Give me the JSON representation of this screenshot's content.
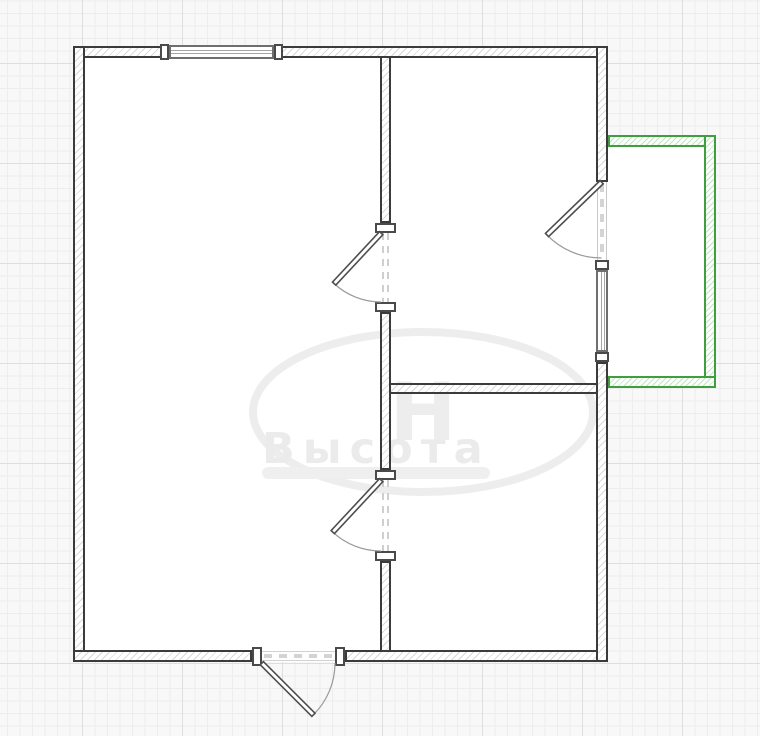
{
  "app": {
    "view": "floor-plan-canvas"
  },
  "watermark": {
    "text": "Высота",
    "monogram": "Н"
  },
  "colors": {
    "canvas_bg": "#f8f8f8",
    "grid_minor": "#ededed",
    "grid_major": "#dedede",
    "wall_line": "#3b3b3b",
    "wall_hatch": "#d9d9d9",
    "balcony_line": "#3f9e3f",
    "balcony_hatch": "#c4e2c4",
    "window_line": "#6f6f6f",
    "window_pane": "#a6a6a6",
    "door_line": "#4e4e4e",
    "door_arc": "#999999",
    "opening_dash": "#cfcfcf",
    "watermark": "#ebebeb"
  },
  "plan": {
    "rects": [
      {
        "name": "room-floor-building",
        "cls": "fill",
        "x": 73,
        "y": 46,
        "w": 535,
        "h": 616,
        "i": "true"
      },
      {
        "name": "room-floor-balcony",
        "cls": "fill",
        "x": 608,
        "y": 135,
        "w": 108,
        "h": 253,
        "i": "true"
      },
      {
        "name": "wall-exterior-top",
        "cls": "wall",
        "x": 73,
        "y": 46,
        "w": 535,
        "h": 12,
        "i": "true"
      },
      {
        "name": "wall-exterior-left",
        "cls": "wall",
        "x": 73,
        "y": 46,
        "w": 12,
        "h": 616,
        "i": "true"
      },
      {
        "name": "wall-exterior-bottom-left",
        "cls": "wall",
        "x": 73,
        "y": 650,
        "w": 179,
        "h": 12,
        "i": "true"
      },
      {
        "name": "wall-exterior-bottom-right",
        "cls": "wall",
        "x": 345,
        "y": 650,
        "w": 263,
        "h": 12,
        "i": "true"
      },
      {
        "name": "wall-exterior-right-upper",
        "cls": "wall",
        "x": 596,
        "y": 46,
        "w": 12,
        "h": 136,
        "i": "true"
      },
      {
        "name": "wall-exterior-right-lower",
        "cls": "wall",
        "x": 596,
        "y": 362,
        "w": 12,
        "h": 300,
        "i": "true"
      },
      {
        "name": "wall-interior-vertical-upper",
        "cls": "wall",
        "x": 380,
        "y": 56,
        "w": 11,
        "h": 167,
        "i": "true"
      },
      {
        "name": "wall-interior-vertical-middle",
        "cls": "wall",
        "x": 380,
        "y": 312,
        "w": 11,
        "h": 158,
        "i": "true"
      },
      {
        "name": "wall-interior-vertical-lower",
        "cls": "wall",
        "x": 380,
        "y": 561,
        "w": 11,
        "h": 91,
        "i": "true"
      },
      {
        "name": "wall-interior-horizontal",
        "cls": "wall",
        "x": 389,
        "y": 383,
        "w": 209,
        "h": 11,
        "i": "true"
      },
      {
        "name": "balcony-wall-top",
        "cls": "gwall",
        "x": 608,
        "y": 135,
        "w": 108,
        "h": 12,
        "i": "true"
      },
      {
        "name": "balcony-wall-right",
        "cls": "gwall",
        "x": 704,
        "y": 135,
        "w": 12,
        "h": 253,
        "i": "true"
      },
      {
        "name": "balcony-wall-bottom",
        "cls": "gwall",
        "x": 608,
        "y": 376,
        "w": 108,
        "h": 12,
        "i": "true"
      },
      {
        "name": "window-top",
        "cls": "window-h",
        "x": 169,
        "y": 45,
        "w": 105,
        "h": 14,
        "i": "true"
      },
      {
        "name": "window-right",
        "cls": "window-v",
        "x": 596,
        "y": 270,
        "w": 12,
        "h": 82,
        "i": "true"
      },
      {
        "name": "window-top-cap-left",
        "cls": "frame",
        "x": 160,
        "y": 44,
        "w": 9,
        "h": 16,
        "i": "false"
      },
      {
        "name": "window-top-cap-right",
        "cls": "frame",
        "x": 274,
        "y": 44,
        "w": 9,
        "h": 16,
        "i": "false"
      },
      {
        "name": "window-right-cap-top",
        "cls": "frame",
        "x": 595,
        "y": 260,
        "w": 14,
        "h": 10,
        "i": "false"
      },
      {
        "name": "window-right-cap-bottom",
        "cls": "frame",
        "x": 595,
        "y": 352,
        "w": 14,
        "h": 10,
        "i": "false"
      },
      {
        "name": "door-interior-1-jamb-top",
        "cls": "frame",
        "x": 375,
        "y": 223,
        "w": 21,
        "h": 10,
        "i": "false"
      },
      {
        "name": "door-interior-1-jamb-bottom",
        "cls": "frame",
        "x": 375,
        "y": 302,
        "w": 21,
        "h": 10,
        "i": "false"
      },
      {
        "name": "door-interior-2-jamb-top",
        "cls": "frame",
        "x": 375,
        "y": 470,
        "w": 21,
        "h": 10,
        "i": "false"
      },
      {
        "name": "door-interior-2-jamb-bottom",
        "cls": "frame",
        "x": 375,
        "y": 551,
        "w": 21,
        "h": 10,
        "i": "false"
      },
      {
        "name": "door-entry-jamb-left",
        "cls": "frame",
        "x": 252,
        "y": 647,
        "w": 10,
        "h": 19,
        "i": "false"
      },
      {
        "name": "door-entry-jamb-right",
        "cls": "frame",
        "x": 335,
        "y": 647,
        "w": 10,
        "h": 19,
        "i": "false"
      }
    ],
    "lines": [
      {
        "name": "door-interior-1-opening",
        "x1": 383,
        "y1": 233,
        "x2": 383,
        "y2": 302,
        "w": 2,
        "dash": "7 6",
        "c": "#cfcfcf"
      },
      {
        "name": "door-interior-1-opening",
        "x1": 388,
        "y1": 233,
        "x2": 388,
        "y2": 302,
        "w": 2,
        "dash": "7 6",
        "c": "#cfcfcf"
      },
      {
        "name": "door-interior-2-opening",
        "x1": 383,
        "y1": 480,
        "x2": 383,
        "y2": 551,
        "w": 2,
        "dash": "7 6",
        "c": "#cfcfcf"
      },
      {
        "name": "door-interior-2-opening",
        "x1": 388,
        "y1": 480,
        "x2": 388,
        "y2": 551,
        "w": 2,
        "dash": "7 6",
        "c": "#cfcfcf"
      },
      {
        "name": "door-balcony-opening-jamb",
        "x1": 597.5,
        "y1": 182,
        "x2": 597.5,
        "y2": 260,
        "w": 1,
        "dash": "",
        "c": "#c9c9c9"
      },
      {
        "name": "door-balcony-opening-jamb",
        "x1": 606.5,
        "y1": 182,
        "x2": 606.5,
        "y2": 260,
        "w": 1,
        "dash": "",
        "c": "#c9c9c9"
      },
      {
        "name": "door-balcony-opening",
        "x1": 602,
        "y1": 184,
        "x2": 602,
        "y2": 258,
        "w": 4,
        "dash": "8 7",
        "c": "#d4d4d4"
      },
      {
        "name": "door-entry-opening-edge",
        "x1": 262,
        "y1": 651.5,
        "x2": 335,
        "y2": 651.5,
        "w": 1,
        "dash": "",
        "c": "#d2d2d2"
      },
      {
        "name": "door-entry-opening-edge",
        "x1": 262,
        "y1": 660.5,
        "x2": 335,
        "y2": 660.5,
        "w": 1,
        "dash": "",
        "c": "#d2d2d2"
      },
      {
        "name": "door-entry-opening",
        "x1": 264,
        "y1": 656,
        "x2": 333,
        "y2": 656,
        "w": 4,
        "dash": "8 7",
        "c": "#d4d4d4"
      }
    ],
    "leaves": [
      {
        "name": "door-interior-1-leaf",
        "x": 379,
        "y": 233,
        "w": 4.5,
        "h": 69,
        "rot": 43,
        "cx": 381,
        "cy": 233
      },
      {
        "name": "door-interior-2-leaf",
        "x": 379,
        "y": 480,
        "w": 4.5,
        "h": 71,
        "rot": 43,
        "cx": 381,
        "cy": 480
      },
      {
        "name": "door-balcony-leaf",
        "x": 599.5,
        "y": 182,
        "w": 4.5,
        "h": 76,
        "rot": 46,
        "cx": 601.5,
        "cy": 182
      },
      {
        "name": "door-entry-leaf",
        "x": 262,
        "y": 661,
        "w": 73,
        "h": 4.5,
        "rot": 45,
        "cx": 262,
        "cy": 663
      }
    ],
    "arcs": [
      {
        "name": "door-interior-1-arc",
        "d": "M 334 283.5 A 69 69 0 0 0 381 302"
      },
      {
        "name": "door-interior-2-arc",
        "d": "M 332.6 531.9 A 71 71 0 0 0 381 551"
      },
      {
        "name": "door-balcony-arc",
        "d": "M 546.8 234.8 A 76 76 0 0 0 601.5 258"
      },
      {
        "name": "door-entry-arc",
        "d": "M 313.6 714.6 A 73 73 0 0 0 335 663"
      }
    ]
  }
}
